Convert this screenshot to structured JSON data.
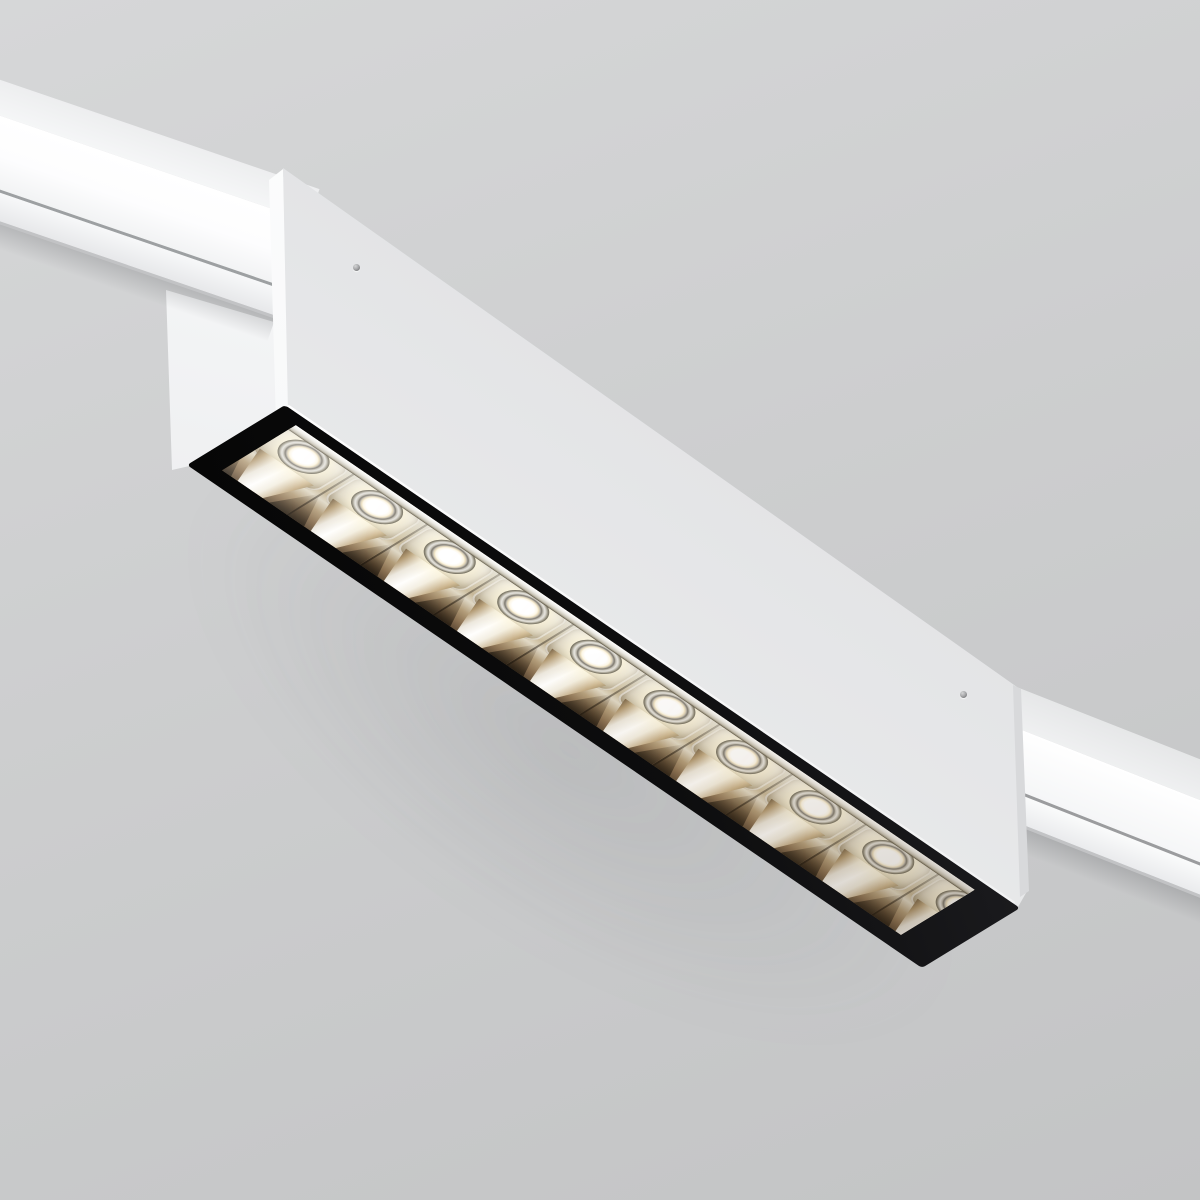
{
  "scene": {
    "description": "3D product render of a white linear magnetic-track LED luminaire viewed from below at an angle; the fixture hangs from a white ceiling track and its black-framed lens holds ten square metallic reflector cells with glowing warm-white LEDs",
    "background_top_color": "#d6d7d8",
    "background_bottom_color": "#c3c4c5"
  },
  "track": {
    "color": "#ffffff",
    "segment_count": 2,
    "segments": [
      {
        "id": "left",
        "angle_deg": 18.9
      },
      {
        "id": "right",
        "angle_deg": 21.5
      }
    ]
  },
  "fixture": {
    "body_color": "#ebeced",
    "endcap_color": "#fbfcfd",
    "screw_count": 2,
    "lens": {
      "frame_color": "#0d0d0e",
      "led_count": 10,
      "reflector_finish_colors": [
        "#ffffff",
        "#cdc4ae",
        "#8a7051"
      ],
      "led_core_color": "#ffffff",
      "led_glow_color": "#fff3cd"
    }
  }
}
